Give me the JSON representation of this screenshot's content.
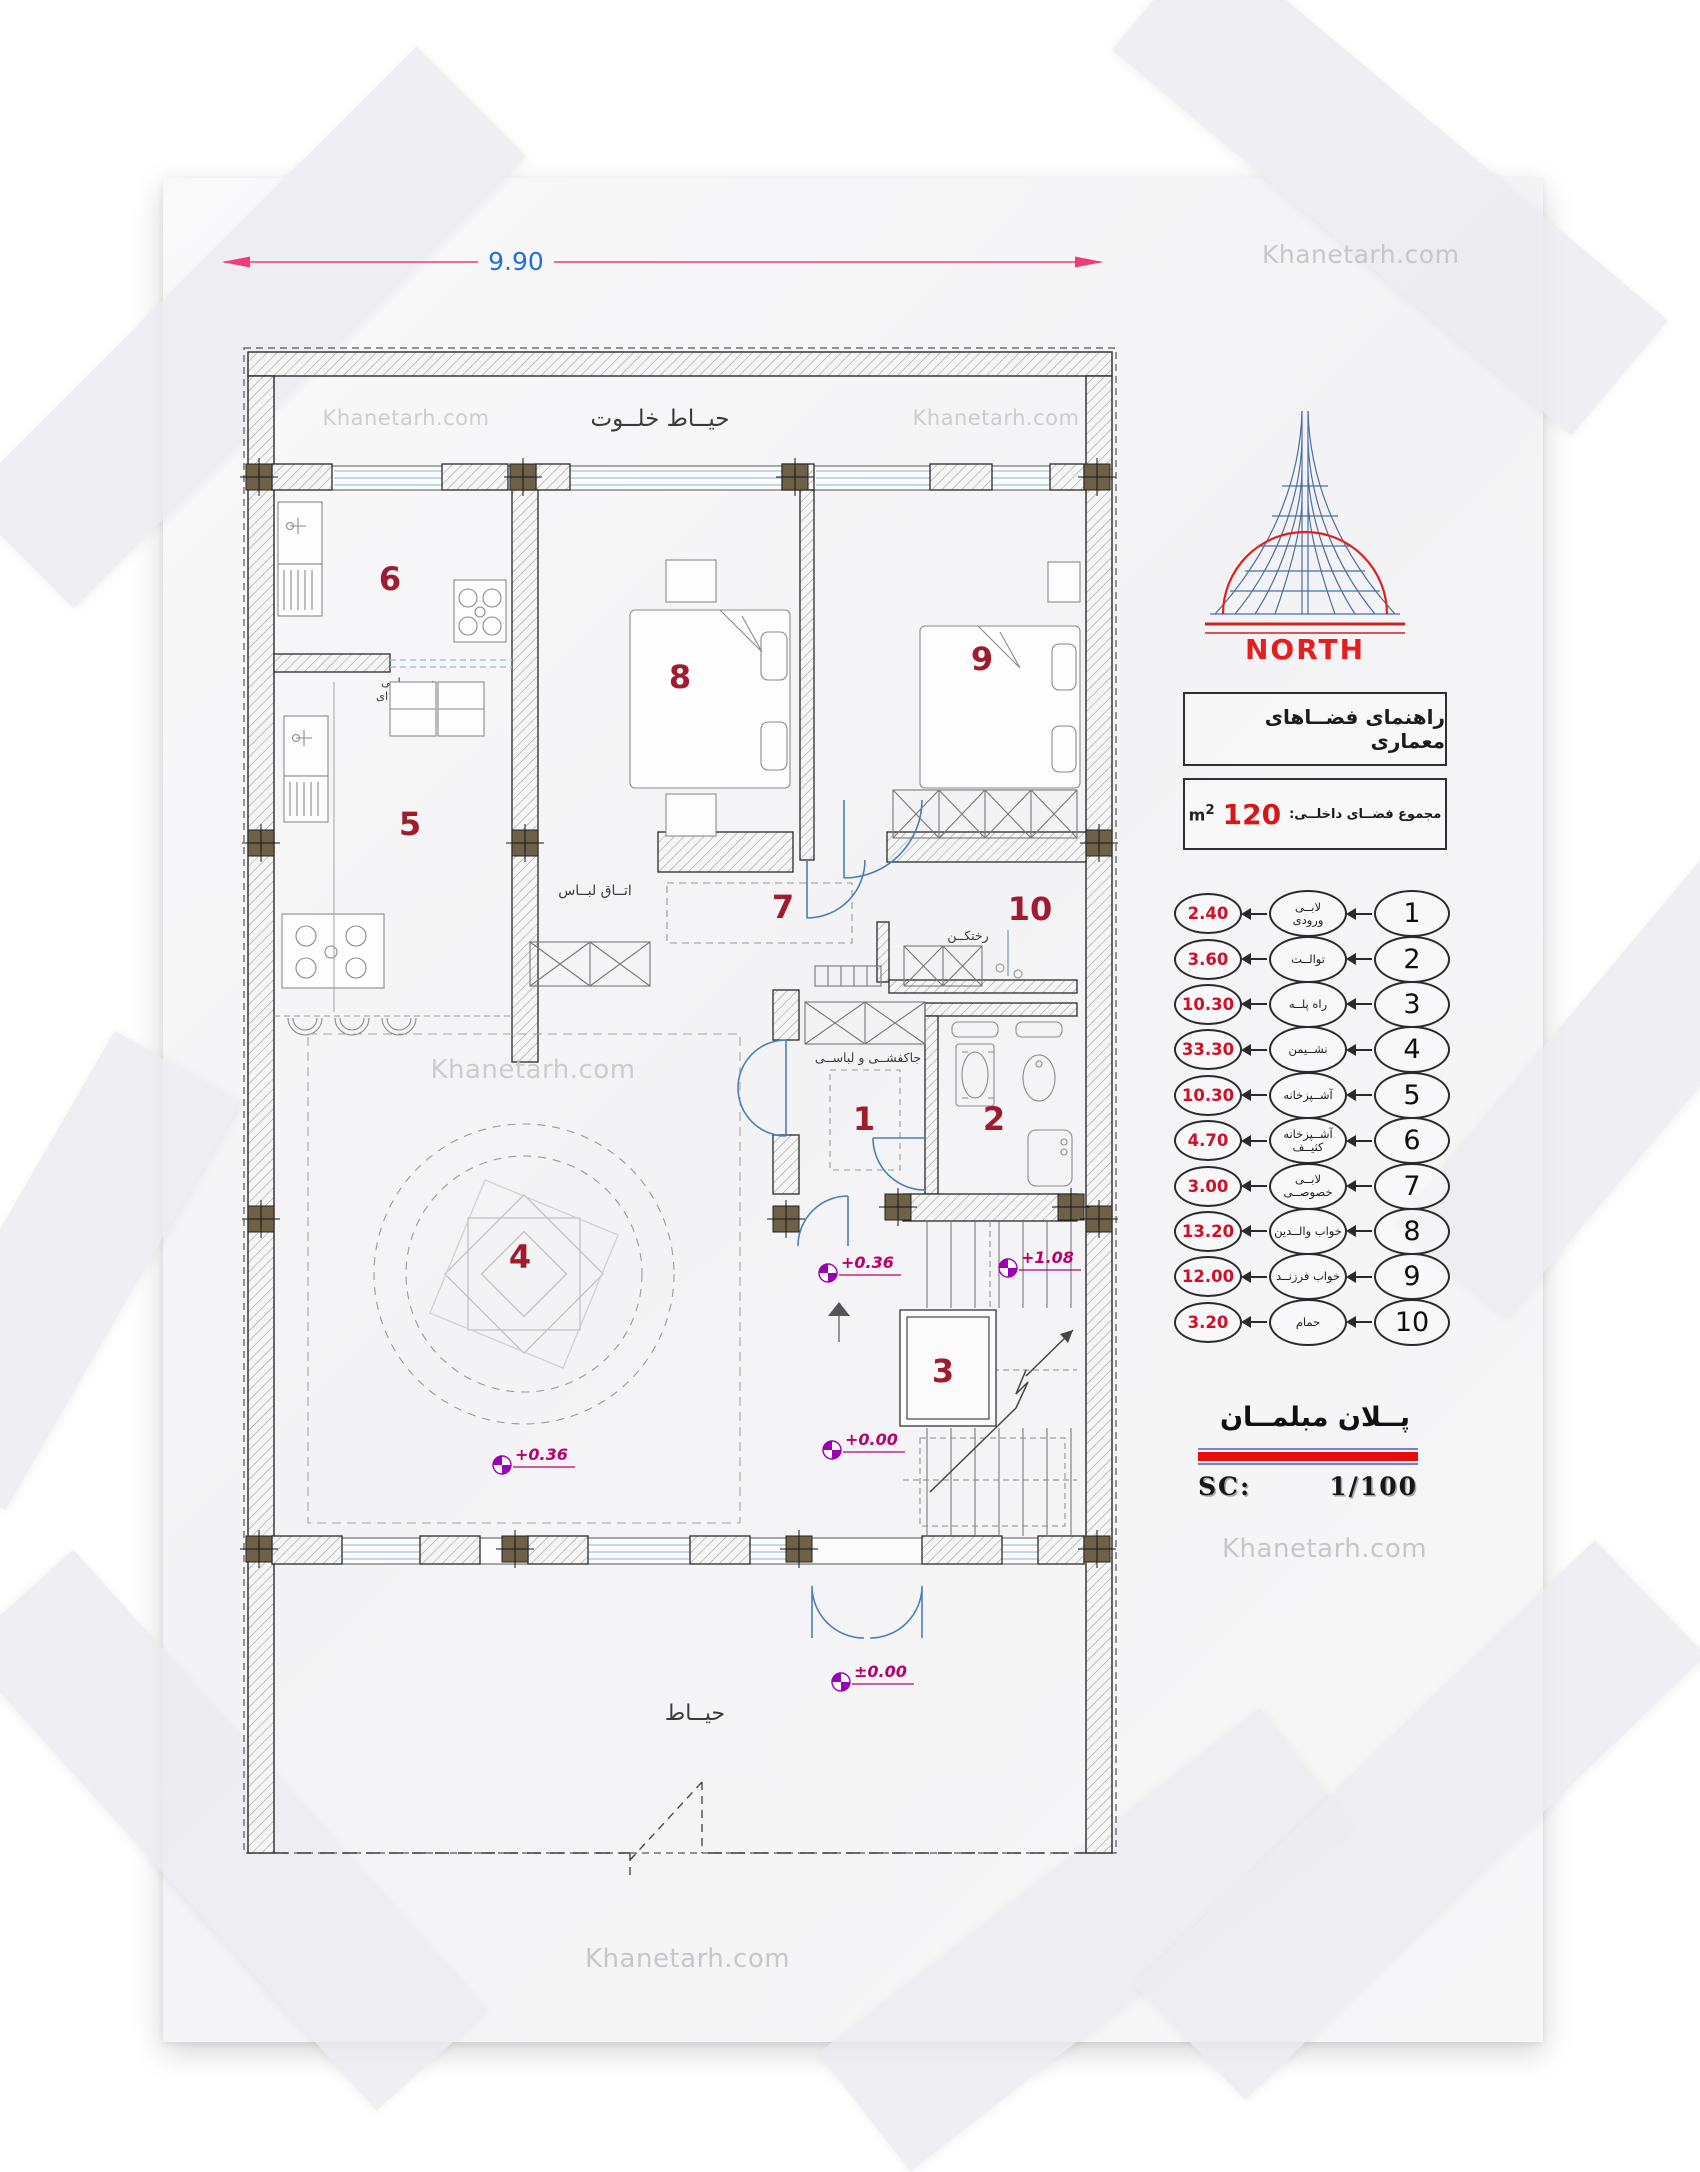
{
  "watermark": "Khanetarh.com",
  "colors": {
    "room_number": "#9e1c2e",
    "legend_area_red": "#ce1126",
    "north_red": "#e41f1f",
    "dimension_text_blue": "#2170d8",
    "dimension_line_pink": "#f03c78",
    "elevation_marker_purple": "#9b00b4",
    "door_blue": "#4a7fb5",
    "column_brown": "#6f6147"
  },
  "dimension": {
    "width_label": "9.90"
  },
  "north": {
    "label": "NORTH"
  },
  "panel": {
    "guide_title": "راهنمای فضــاهای معماری",
    "total_label": "مجموع فضــای داخلــی:",
    "total_value": "120",
    "total_unit": "m",
    "total_unit_exp": "2",
    "legend": [
      {
        "no": "1",
        "name": "لابــی\nورودی",
        "area": "2.40"
      },
      {
        "no": "2",
        "name": "توالــت",
        "area": "3.60"
      },
      {
        "no": "3",
        "name": "راه پلــه",
        "area": "10.30"
      },
      {
        "no": "4",
        "name": "نشــیمن",
        "area": "33.30"
      },
      {
        "no": "5",
        "name": "آشــپزخانه",
        "area": "10.30"
      },
      {
        "no": "6",
        "name": "آشــپزخانه\nکثیــف",
        "area": "4.70"
      },
      {
        "no": "7",
        "name": "لابــی\nخصوصــی",
        "area": "3.00"
      },
      {
        "no": "8",
        "name": "خواب والــدین",
        "area": "13.20"
      },
      {
        "no": "9",
        "name": "خواب فرزنــد",
        "area": "12.00"
      },
      {
        "no": "10",
        "name": "حمام",
        "area": "3.20"
      }
    ],
    "plan_title": "پــلان مبلمــان",
    "scale_label": "SC:",
    "scale_value": "1/100"
  },
  "plan": {
    "room_numbers": [
      "1",
      "2",
      "3",
      "4",
      "5",
      "6",
      "7",
      "8",
      "9",
      "10"
    ],
    "labels": {
      "backyard": "حیــاط خلــوت",
      "yard": "حیــاط",
      "dressing_room": "اتــاق لبــاس",
      "sliding_door_1": "درب ریلــی",
      "sliding_door_2": "شیشــه ای",
      "changing": "رختکــن",
      "shoe_rack": "جاکفشــی و لباســی"
    },
    "elevations": {
      "living": "+0.36",
      "stair_mid": "+0.36",
      "stair_top": "+1.08",
      "stair_base": "+0.00",
      "yard": "±0.00"
    }
  }
}
